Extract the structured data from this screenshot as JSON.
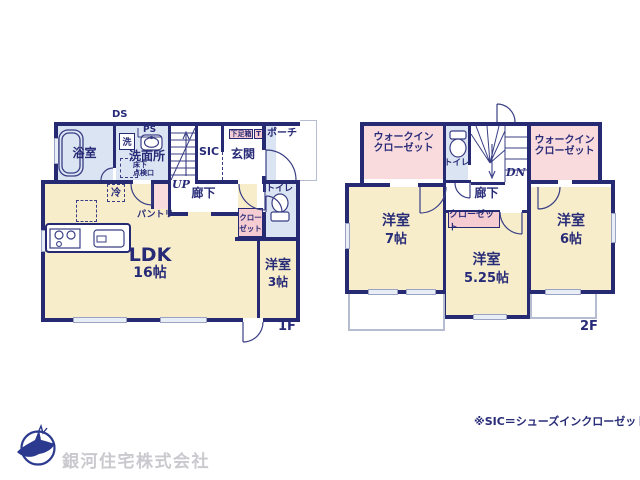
{
  "colors": {
    "wall_navy": "#252a73",
    "text_navy": "#272b77",
    "room_cream": "#f7edcb",
    "room_light_blue": "#dbe4f3",
    "room_pink": "#f9dadd",
    "label_box_pink": "#f6ccd3",
    "outline_gray": "#b6bdd1",
    "company_gray": "#c9c9ce",
    "logo_navy": "#2b3a8e"
  },
  "floor1": {
    "floor_label": "1F",
    "ds": "DS",
    "ps": "PS",
    "up": "UP",
    "bath": "浴室",
    "washer": "洗",
    "washroom": "洗面所",
    "hatch_l1": "床下",
    "hatch_l2": "点検口",
    "sic": "SIC",
    "genkan": "玄関",
    "shoe_box": "下足箱",
    "t_box": "T",
    "porch": "ポーチ",
    "hall": "廊下",
    "toilet": "トイレ",
    "closet_l1": "クロー",
    "closet_l2": "ゼット",
    "pantry": "パントリー",
    "fridge": "冷",
    "ldk": "LDK",
    "ldk_size": "16帖",
    "bedroom": "洋室",
    "bedroom_size": "3帖"
  },
  "floor2": {
    "floor_label": "2F",
    "dn": "DN",
    "wic_left_l1": "ウォークイン",
    "wic_left_l2": "クローゼット",
    "wic_right_l1": "ウォークイン",
    "wic_right_l2": "クローゼット",
    "toilet": "トイレ",
    "storage": "収納",
    "hall": "廊下",
    "closet": "クローゼット",
    "bedroom7": "洋室",
    "bedroom7_size": "7帖",
    "bedroom525": "洋室",
    "bedroom525_size": "5.25帖",
    "bedroom6": "洋室",
    "bedroom6_size": "6帖"
  },
  "footer": {
    "note": "※SIC＝シューズインクローゼット",
    "company": "銀河住宅株式会社"
  }
}
